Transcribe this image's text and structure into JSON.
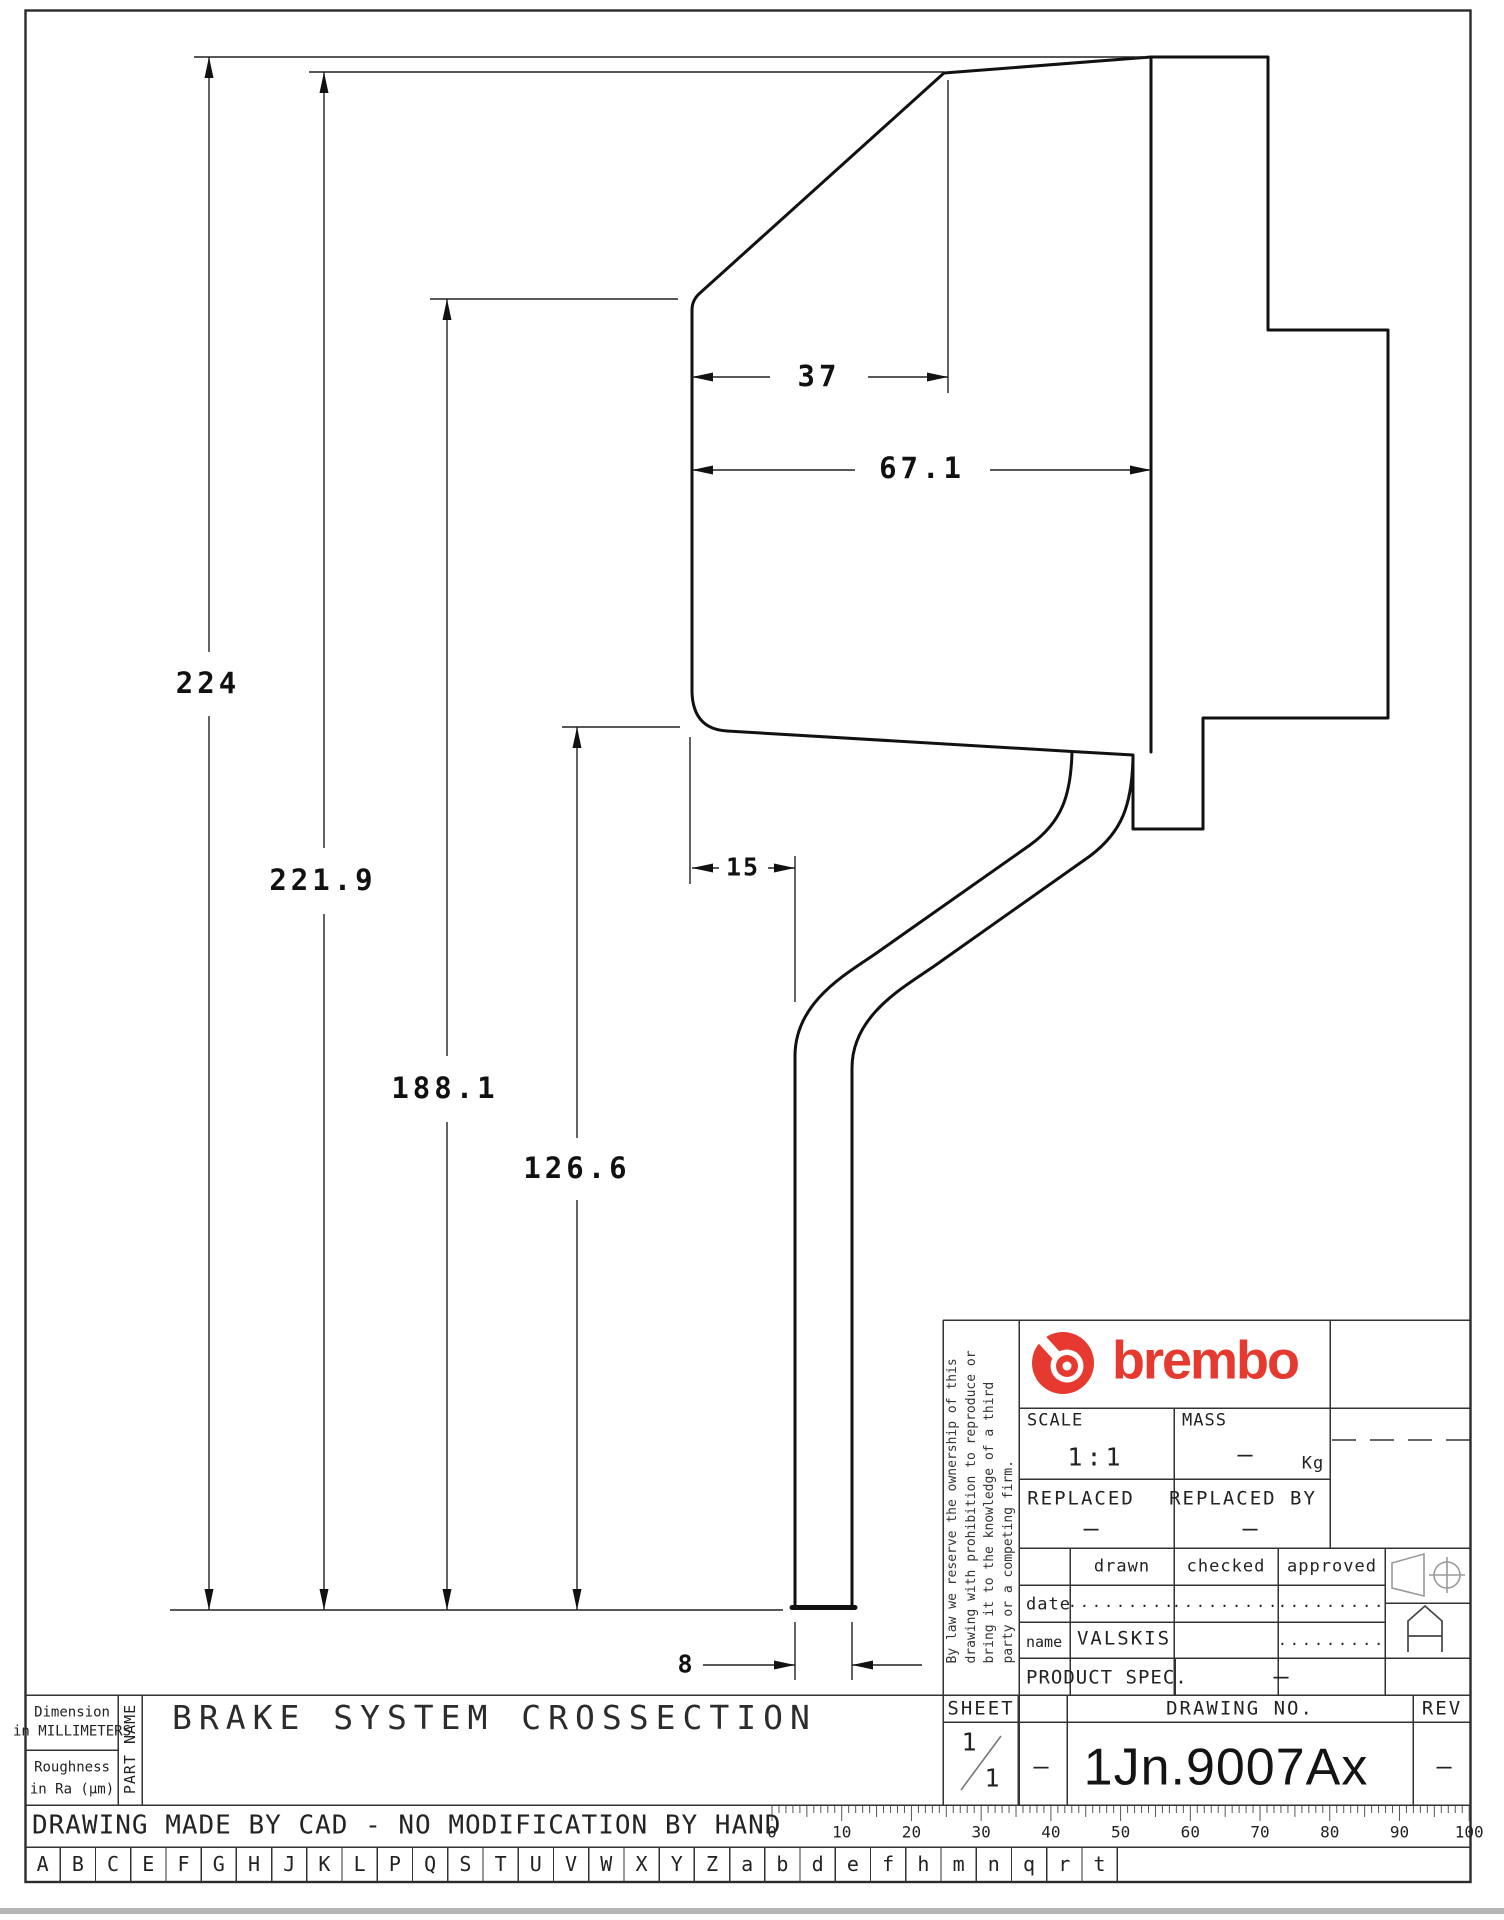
{
  "dimensions": {
    "height_total": "224",
    "height_2": "221.9",
    "height_3": "188.1",
    "height_4": "126.6",
    "width_top": "37",
    "width_mid": "67.1",
    "width_flange": "15",
    "width_column": "8"
  },
  "disclaimer": {
    "line1": "By law we reserve the ownership of this",
    "line2": "drawing with prohibition to reproduce or",
    "line3": "bring it to the knowledge of a third",
    "line4": "party or a competing firm."
  },
  "title_block": {
    "logo_text": "brembo",
    "scale_label": "SCALE",
    "scale_value": "1:1",
    "mass_label": "MASS",
    "mass_value": "–",
    "mass_unit": "Kg",
    "replaced_label": "REPLACED",
    "replaced_value": "–",
    "replaced_by_label": "REPLACED BY",
    "replaced_by_value": "–",
    "drawn_label": "drawn",
    "checked_label": "checked",
    "approved_label": "approved",
    "date_label": "date",
    "date_drawn": ".........",
    "date_checked": ".........",
    "date_approved": ".........",
    "name_label": "name",
    "name_drawn": "VALSKIS",
    "name_approved": ".........",
    "product_spec_label": "PRODUCT SPEC.",
    "product_spec_value": "–",
    "sheet_label": "SHEET",
    "sheet_numerator": "1",
    "sheet_denominator": "1",
    "col2_value": "–",
    "drawing_no_label": "DRAWING NO.",
    "drawing_no_value": "1Jn.9007Ax",
    "rev_label": "REV",
    "rev_value": "–"
  },
  "part_info": {
    "dim_note_line1": "Dimension",
    "dim_note_line2": "in MILLIMETERS",
    "rough_note_line1": "Roughness",
    "rough_note_line2": "in Ra (μm)",
    "part_name_label": "PART NAME",
    "part_name": "BRAKE SYSTEM CROSSECTION"
  },
  "footer": {
    "cad_note": "DRAWING MADE BY CAD - NO MODIFICATION BY HAND",
    "ruler_labels": [
      "0",
      "10",
      "20",
      "30",
      "40",
      "50",
      "60",
      "70",
      "80",
      "90",
      "100"
    ],
    "letters": [
      "A",
      "B",
      "C",
      "E",
      "F",
      "G",
      "H",
      "J",
      "K",
      "L",
      "P",
      "Q",
      "S",
      "T",
      "U",
      "V",
      "W",
      "X",
      "Y",
      "Z",
      "a",
      "b",
      "d",
      "e",
      "f",
      "h",
      "m",
      "n",
      "q",
      "r",
      "t"
    ]
  },
  "colors": {
    "brand_red": "#e63a30",
    "line_dark": "#111111"
  }
}
